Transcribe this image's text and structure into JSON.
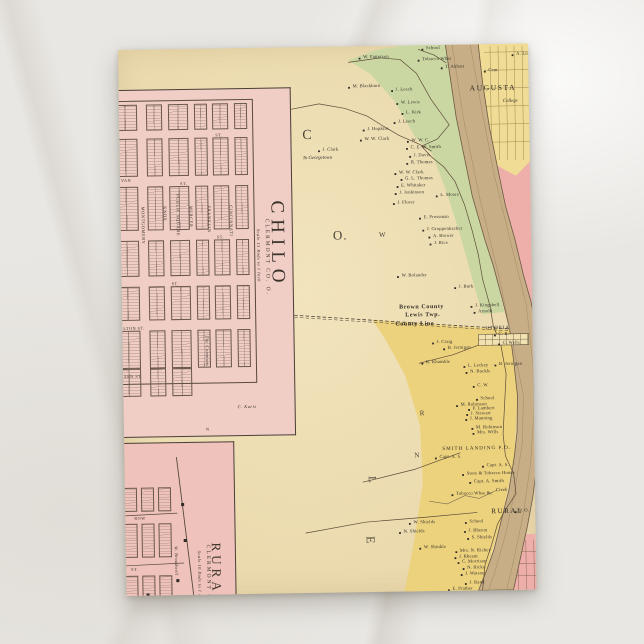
{
  "postcard": {
    "description": "Antique atlas postcard: Ohio River with Chilo and Rural town plats, Clermont Co. Ohio, Augusta opposite",
    "palette": {
      "card_tan": "#ebdaae",
      "inset_pink": "#f0cdc5",
      "rural_pink": "#efc2bb",
      "bank_green": "#cbd7a2",
      "franklin_yellow": "#edd27e",
      "augusta_yellow": "#f0dc94",
      "kentucky_pink": "#eeafab",
      "river_tan": "#c7ae86",
      "ink": "#33302a"
    },
    "big_letters": [
      {
        "t": "C",
        "x": 183,
        "y": 82,
        "s": 14,
        "r": 0
      },
      {
        "t": "O.",
        "x": 212,
        "y": 182,
        "s": 13,
        "r": 0
      },
      {
        "t": "W",
        "x": 258,
        "y": 186,
        "s": 7,
        "r": 0
      },
      {
        "t": "R",
        "x": 296,
        "y": 365,
        "s": 7,
        "r": 0
      },
      {
        "t": "N",
        "x": 290,
        "y": 407,
        "s": 7,
        "r": 0
      },
      {
        "t": "L",
        "x": 252,
        "y": 430,
        "s": 11,
        "r": 90
      },
      {
        "t": "E",
        "x": 251,
        "y": 490,
        "s": 12,
        "r": 90
      }
    ]
  },
  "insets": {
    "chilo": {
      "title": "CHILO",
      "subtitle": "CLERMONT CO. O.",
      "scale_note": "Scale 15 Rods to 1 Inch",
      "vertical_streets": [
        {
          "name": "MONTGOMERY",
          "x": 24
        },
        {
          "name": "KNOX",
          "x": 46
        },
        {
          "name": "MERCER",
          "x": 72
        },
        {
          "name": "FRANKLIN",
          "x": 90
        },
        {
          "name": "CINCINNATI",
          "x": 112
        }
      ],
      "square_label": "PUBLIC SQUARE",
      "row_labels": [
        {
          "t": "ST.",
          "x": 96,
          "y": 44
        },
        {
          "t": "VAN",
          "x": 1,
          "y": 88
        },
        {
          "t": "ST.",
          "x": 60,
          "y": 92
        },
        {
          "t": "ST.",
          "x": 96,
          "y": 146
        },
        {
          "t": "ST.",
          "x": 50,
          "y": 192
        },
        {
          "t": "LTON ST.",
          "x": 1,
          "y": 236
        },
        {
          "t": "ZEN ST.",
          "x": 1,
          "y": 284
        }
      ],
      "notes": [
        {
          "t": "The Commons",
          "x": 86,
          "y": 246,
          "r": 90,
          "cls": "l-scale"
        },
        {
          "t": "C. Kurtz",
          "x": 114,
          "y": 316,
          "r": 0,
          "cls": "l-scale"
        },
        {
          "t": "N",
          "x": 82,
          "y": 338,
          "r": 0,
          "cls": "l-st"
        }
      ],
      "grid": {
        "cols": [
          [
            -6,
            24
          ],
          [
            27,
            16
          ],
          [
            49,
            20
          ],
          [
            75,
            13
          ],
          [
            93,
            16
          ],
          [
            115,
            13
          ]
        ],
        "rows": [
          [
            14,
            26
          ],
          [
            48,
            38
          ],
          [
            96,
            44
          ],
          [
            150,
            36
          ],
          [
            196,
            34
          ],
          [
            240,
            38
          ]
        ],
        "lower_rows": [
          [
            278,
            28
          ]
        ],
        "lower_cols": [
          [
            -6,
            24
          ],
          [
            27,
            16
          ],
          [
            49,
            20
          ]
        ]
      }
    },
    "rural": {
      "title": "RURAL",
      "subtitle": "CLERMONT CO. O.",
      "scale_note": "Scale 10 Rods to 1 Inch",
      "row_labels": [
        {
          "t": "ROW",
          "x": 9,
          "y": 73
        },
        {
          "t": "ST.",
          "x": 5,
          "y": 124
        },
        {
          "t": "ST.",
          "x": 12,
          "y": 163
        }
      ],
      "notes": [
        {
          "t": "W. Broadwell",
          "x": 52,
          "y": 103,
          "r": 90,
          "cls": "l-scale"
        },
        {
          "t": "Store",
          "x": 38,
          "y": 192,
          "r": 0,
          "cls": "l-scale"
        }
      ],
      "grid": {
        "cols": [
          [
            -4,
            16
          ],
          [
            16,
            13
          ],
          [
            33,
            13
          ]
        ],
        "rows": [
          [
            44,
            24
          ],
          [
            80,
            34
          ],
          [
            132,
            24
          ],
          [
            170,
            26
          ]
        ]
      }
    }
  },
  "map": {
    "towns_on_map": [
      "AUGUSTA",
      "UTOPIA",
      "SMITH LANDING P.O.",
      "RURAL"
    ],
    "county_line": {
      "line1": "Brown County",
      "line2": "Lewis Twp.",
      "line3": "County Line"
    },
    "labels": [
      {
        "t": "W. Patterson",
        "x": 245,
        "y": 9
      },
      {
        "t": "School",
        "x": 308,
        "y": 1
      },
      {
        "t": "Tobacco Whse",
        "x": 304,
        "y": 12
      },
      {
        "t": "T. Abbott",
        "x": 327,
        "y": 20
      },
      {
        "t": "M. Blackburn",
        "x": 234,
        "y": 38
      },
      {
        "t": "J. Leech",
        "x": 277,
        "y": 42
      },
      {
        "t": "W. Lewis",
        "x": 282,
        "y": 55
      },
      {
        "t": "L. Kirk",
        "x": 287,
        "y": 65
      },
      {
        "t": "J. Leech",
        "x": 279,
        "y": 74
      },
      {
        "t": "J. Hopkins",
        "x": 248,
        "y": 81
      },
      {
        "t": "W. W. Clark",
        "x": 245,
        "y": 91
      },
      {
        "t": "J. Clark",
        "x": 203,
        "y": 101
      },
      {
        "t": "To Georgetown",
        "x": 183,
        "y": 110,
        "cls": "l-road"
      },
      {
        "t": "W. W. C.",
        "x": 292,
        "y": 93
      },
      {
        "t": "C. E. W. Smith",
        "x": 291,
        "y": 100
      },
      {
        "t": "J. Davis",
        "x": 294,
        "y": 108
      },
      {
        "t": "R. Thomas",
        "x": 291,
        "y": 115
      },
      {
        "t": "W. W. Clark",
        "x": 279,
        "y": 125
      },
      {
        "t": "G. L. Thomas",
        "x": 285,
        "y": 131
      },
      {
        "t": "E. Whitaker",
        "x": 281,
        "y": 138
      },
      {
        "t": "J. Jenkinson",
        "x": 279,
        "y": 145
      },
      {
        "t": "J. Florer",
        "x": 277,
        "y": 155
      },
      {
        "t": "L. Moore",
        "x": 320,
        "y": 148
      },
      {
        "t": "E. Prossman",
        "x": 303,
        "y": 170
      },
      {
        "t": "J. Groppenbacher",
        "x": 306,
        "y": 182
      },
      {
        "t": "A. Brewer",
        "x": 312,
        "y": 189
      },
      {
        "t": "J. Rice",
        "x": 313,
        "y": 196
      },
      {
        "t": "W. Bolander",
        "x": 280,
        "y": 228
      },
      {
        "t": "J. Burk",
        "x": 337,
        "y": 240
      },
      {
        "t": "J. Kingsbell",
        "x": 353,
        "y": 259
      },
      {
        "t": "Arnold",
        "x": 356,
        "y": 265
      },
      {
        "t": "UTOPIA",
        "x": 363,
        "y": 282,
        "cls": "l-town"
      },
      {
        "t": "J. Craig",
        "x": 314,
        "y": 295
      },
      {
        "t": "B. Jernigan",
        "x": 325,
        "y": 301
      },
      {
        "t": "B. Jernigan",
        "x": 376,
        "y": 318
      },
      {
        "t": "R. Khamble",
        "x": 303,
        "y": 315
      },
      {
        "t": "L. Leckey",
        "x": 345,
        "y": 319
      },
      {
        "t": "N. Buckle",
        "x": 347,
        "y": 325
      },
      {
        "t": "C. W.",
        "x": 354,
        "y": 339
      },
      {
        "t": "C. B.",
        "x": 376,
        "y": 288
      },
      {
        "t": "C. Wells",
        "x": 380,
        "y": 297
      },
      {
        "t": "School",
        "x": 357,
        "y": 352
      },
      {
        "t": "M. Robinson",
        "x": 337,
        "y": 358
      },
      {
        "t": "F. Lambert",
        "x": 349,
        "y": 362
      },
      {
        "t": "J. Stewart",
        "x": 347,
        "y": 367
      },
      {
        "t": "J. Manning",
        "x": 346,
        "y": 372
      },
      {
        "t": "M. Robinson",
        "x": 352,
        "y": 381
      },
      {
        "t": "Mrs. Wills",
        "x": 353,
        "y": 386
      },
      {
        "t": "SMITH LANDING P.O.",
        "x": 318,
        "y": 402,
        "cls": "l-town"
      },
      {
        "t": "Capt. A. S.",
        "x": 315,
        "y": 410
      },
      {
        "t": "Capt. A. S.",
        "x": 362,
        "y": 419
      },
      {
        "t": "Store & Tobacco House",
        "x": 342,
        "y": 427
      },
      {
        "t": "Capt. A. Smith",
        "x": 349,
        "y": 435
      },
      {
        "t": "Tobacco Whse &c",
        "x": 331,
        "y": 447
      },
      {
        "t": "Creek",
        "x": 371,
        "y": 445,
        "cls": "l-road"
      },
      {
        "t": "RURAL",
        "x": 366,
        "y": 464,
        "cls": "l-rural"
      },
      {
        "t": "P. O.",
        "x": 394,
        "y": 465
      },
      {
        "t": "School",
        "x": 344,
        "y": 475
      },
      {
        "t": "J. Rheem",
        "x": 343,
        "y": 484
      },
      {
        "t": "S. Shields",
        "x": 346,
        "y": 491
      },
      {
        "t": "W. Shields",
        "x": 288,
        "y": 475
      },
      {
        "t": "N. Shields",
        "x": 278,
        "y": 484
      },
      {
        "t": "W. Shinkle",
        "x": 298,
        "y": 500
      },
      {
        "t": "Mrs. N. Richey",
        "x": 334,
        "y": 504
      },
      {
        "t": "J. Rheem",
        "x": 333,
        "y": 510
      },
      {
        "t": "C. Morrison",
        "x": 336,
        "y": 515
      },
      {
        "t": "N. Ricks",
        "x": 341,
        "y": 521
      },
      {
        "t": "J. Watson",
        "x": 339,
        "y": 527
      },
      {
        "t": "J. Rand",
        "x": 343,
        "y": 536
      },
      {
        "t": "E. Prather",
        "x": 326,
        "y": 542
      },
      {
        "t": "AUGUSTA",
        "x": 351,
        "y": 40,
        "cls": "l-city"
      },
      {
        "t": "Cem.",
        "x": 370,
        "y": 24
      },
      {
        "t": "A. Long",
        "x": 398,
        "y": 8
      },
      {
        "t": "College",
        "x": 384,
        "y": 56,
        "cls": "l-road"
      },
      {
        "t": "Brown County",
        "x": 277,
        "y": 259,
        "cls": "l-county"
      },
      {
        "t": "Lewis Twp.",
        "x": 283,
        "y": 267,
        "cls": "l-county"
      },
      {
        "t": "County Line",
        "x": 273,
        "y": 276,
        "cls": "l-county"
      }
    ]
  }
}
